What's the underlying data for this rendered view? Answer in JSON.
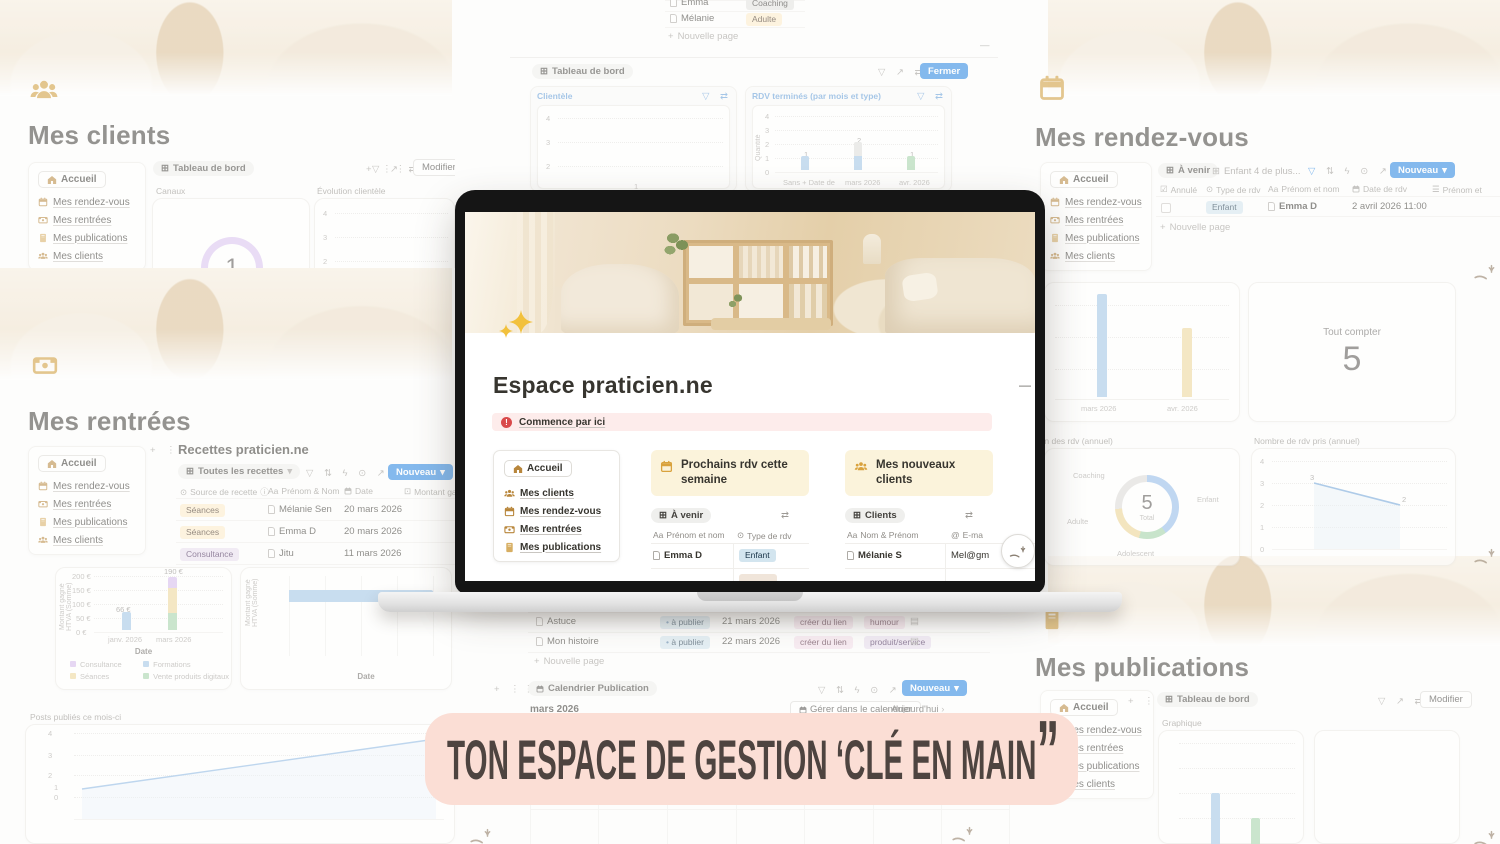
{
  "banner": {
    "text": "TON ESPACE DE GESTION ‘CLÉ EN MAIN",
    "end_quote": "”",
    "bg": "#fbded5",
    "text_color": "#4e4440"
  },
  "common": {
    "accueil": "Accueil",
    "nav_rdv": "Mes rendez-vous",
    "nav_rentrees": "Mes rentrées",
    "nav_publications": "Mes publications",
    "nav_clients": "Mes clients",
    "new_button": "Nouveau",
    "new_page": "Nouvelle page",
    "modify": "Modifier",
    "dashboard": "Tableau de bord"
  },
  "clients": {
    "heading": "Mes clients"
  },
  "rdv": {
    "heading": "Mes rendez-vous",
    "tab_avenir": "À venir",
    "tab_enfant": "Enfant",
    "tab_more": "4 de plus...",
    "col_annule": "Annulé",
    "col_type": "Type de rdv",
    "col_prenom": "Prénom et nom",
    "col_date": "Date de rdv",
    "col_prenom2": "Prénom et",
    "row": {
      "type": "Enfant",
      "name": "Emma D",
      "date": "2 avril 2026 11:00"
    }
  },
  "rentrees": {
    "heading": "Mes rentrées",
    "db_title": "Recettes praticien.ne",
    "tab_toutes": "Toutes les recettes",
    "col_source": "Source de recette",
    "col_nom": "Prénom & Nom",
    "col_date": "Date",
    "col_montant": "Montant gag",
    "rows": [
      {
        "source": "Séances",
        "name": "Mélanie Sen",
        "date": "20 mars 2026"
      },
      {
        "source": "Séances",
        "name": "Emma D",
        "date": "20 mars 2026"
      },
      {
        "source": "Consultance",
        "name": "Jitu",
        "date": "11 mars 2026"
      }
    ]
  },
  "publications": {
    "heading": "Mes publications"
  },
  "top_center": {
    "rows": [
      {
        "name": "Emma",
        "tag": "Coaching"
      },
      {
        "name": "Mélanie",
        "tag": "Adulte"
      }
    ],
    "fermer": "Fermer"
  },
  "bottom_center": {
    "rows": [
      {
        "name": "Astuce",
        "status": "à publier",
        "date": "21 mars 2026",
        "tag1": "créer du lien",
        "tag2": "humour"
      },
      {
        "name": "Mon histoire",
        "status": "à publier",
        "date": "22 mars 2026",
        "tag1": "créer du lien",
        "tag2": "produit/service"
      }
    ],
    "calendar_tab": "Calendrier Publication",
    "month": "mars 2026",
    "manage": "Gérer dans le calendrier",
    "today": "Aujourd'hui",
    "weekdays": [
      "lun.",
      "mar.",
      "mer.",
      "jeu.",
      "ven.",
      "sam.",
      "dim."
    ],
    "days": [
      "2",
      "3",
      "4",
      "5",
      "6",
      "7",
      "8"
    ]
  },
  "laptop": {
    "title": "Espace praticien.ne",
    "callout": "Commence par ici",
    "nav": [
      "Mes clients",
      "Mes rendez-vous",
      "Mes rentrées",
      "Mes publications"
    ],
    "accueil": "Accueil",
    "card_rdv_title": "Prochains rdv cette semaine",
    "card_clients_title": "Mes nouveaux clients",
    "tab_avenir": "À venir",
    "tab_clients": "Clients",
    "col_prenom": "Prénom et nom",
    "col_type": "Type de rdv",
    "col_nom": "Nom & Prénom",
    "col_email": "E-ma",
    "row1_name": "Emma D",
    "row1_tag": "Enfant",
    "row2_name": "Mélanie S",
    "row2_email": "Mel@gm"
  },
  "chart_data": [
    {
      "name": "canaux",
      "type": "donut",
      "title": "Canaux",
      "center": "1",
      "segments": [
        {
          "label": "",
          "frac": 1,
          "color": "#d9c2f0"
        }
      ]
    },
    {
      "name": "evolution-clientele",
      "type": "line",
      "title": "Évolution clientèle",
      "yticks": [
        "4",
        "3",
        "2"
      ]
    },
    {
      "name": "clientele",
      "type": "bar",
      "title": "Clientèle",
      "yticks": [
        "4",
        "3",
        "2"
      ],
      "partial_label": "1"
    },
    {
      "name": "rdv-termines",
      "type": "bar",
      "title": "RDV terminés (par mois et type)",
      "ylabel": "Quantité",
      "yticks": [
        "4",
        "3",
        "2",
        "1",
        "0"
      ],
      "ymax": 4,
      "categories": [
        "Sans + Date de",
        "mars 2026",
        "avr. 2026"
      ],
      "totals": [
        "1",
        "2",
        "1"
      ],
      "series": [
        {
          "name": "blue",
          "color": "#9dc3e6",
          "values": [
            1,
            1,
            0
          ]
        },
        {
          "name": "gray",
          "color": "#dedddb",
          "values": [
            0,
            1,
            0
          ]
        },
        {
          "name": "green",
          "color": "#a2d3a8",
          "values": [
            0,
            0,
            1
          ]
        }
      ]
    },
    {
      "name": "rdv-par-mois",
      "type": "bar",
      "categories": [
        "mars 2026",
        "avr. 2026"
      ],
      "values": [
        3,
        2
      ],
      "labels": [
        "3",
        "2"
      ],
      "colors": [
        "#9dc3e6",
        "#eed698"
      ],
      "ymax": 4
    },
    {
      "name": "tout-compter",
      "type": "number",
      "title": "Tout compter",
      "value": "5"
    },
    {
      "name": "repartition-rdv",
      "type": "donut",
      "title": "Répartition des rdv (annuel)",
      "center": "5",
      "center_sub": "Total",
      "segments": [
        {
          "label": "Enfant",
          "frac": 0.4,
          "color": "#8fb9e9"
        },
        {
          "label": "Adolescent",
          "frac": 0.14,
          "color": "#9ed0a4"
        },
        {
          "label": "Adulte",
          "frac": 0.2,
          "color": "#ecd28e"
        },
        {
          "label": "Coaching",
          "frac": 0.26,
          "color": "#dcdad7"
        }
      ]
    },
    {
      "name": "nb-rdv-pris",
      "type": "line",
      "title": "Nombre de rdv pris (annuel)",
      "yticks": [
        "4",
        "3",
        "2",
        "1",
        "0"
      ],
      "ymax": 4,
      "points": [
        {
          "label": "3",
          "value": 3
        },
        {
          "label": "2",
          "value": 2
        }
      ]
    },
    {
      "name": "montant-gagne",
      "type": "stacked-bar",
      "ylabel": "Montant gagné HTVA (Somme)",
      "xlabel": "Date",
      "ymax": 200,
      "yticks": [
        "200 €",
        "150 €",
        "100 €",
        "50 €",
        "0 €"
      ],
      "categories": [
        "janv. 2026",
        "mars 2026"
      ],
      "bar_labels": [
        "66 €",
        "190 €"
      ],
      "series": [
        {
          "name": "Formations",
          "color": "#9dc3e6",
          "values": [
            66,
            0
          ]
        },
        {
          "name": "Vente produits digitaux",
          "color": "#a2d3a8",
          "values": [
            0,
            60
          ]
        },
        {
          "name": "Séances",
          "color": "#eed698",
          "values": [
            0,
            90
          ]
        },
        {
          "name": "Consultance",
          "color": "#d4b9ec",
          "values": [
            0,
            40
          ]
        }
      ],
      "legend": [
        "Consultance",
        "Séances",
        "Formations",
        "Vente produits digitaux"
      ]
    },
    {
      "name": "montant-tva",
      "type": "hbar",
      "ylabel": "Trimestre",
      "xlabel": "Montant TVA (€) (Somme)",
      "xmax": 60,
      "categories": [
        "2026 T1"
      ],
      "values": [
        53.81
      ],
      "value_labels": [
        "53,81"
      ],
      "xticks": [
        "0,00",
        "15,00",
        "30,00",
        "45,00",
        "60,00"
      ]
    },
    {
      "name": "toutes-recettes",
      "type": "area-line",
      "title": "Toutes les recettes",
      "ylabel": "Montant gagné HTVA (Somme)",
      "xlabel": "Date",
      "yticks": [
        "200 €",
        "150 €",
        "100 €",
        "66 €",
        "50 €",
        "0 €"
      ],
      "x": [
        "janv. 2026",
        "mars 2026"
      ],
      "values": [
        66,
        190
      ],
      "end_label": "190 €"
    },
    {
      "name": "posts-publies",
      "type": "bar",
      "title": "Posts publiés ce mois-ci",
      "yticks": [
        "4",
        "3",
        "2",
        "1",
        "0"
      ],
      "ymax": 4,
      "values": [
        2,
        1
      ],
      "labels": [
        "2",
        "1"
      ],
      "colors": [
        "#9dc3e6",
        "#a2d3a8"
      ]
    },
    {
      "name": "graphique",
      "type": "donut",
      "title": "Graphique",
      "center": "3",
      "segments": [
        {
          "label": "humour",
          "frac": 0.375,
          "color": "#edbcbc"
        },
        {
          "label": "organisation",
          "frac": 0.25,
          "color": "#e3c99a"
        },
        {
          "label": "produit/service",
          "frac": 0.375,
          "color": "#8fb9e9"
        }
      ]
    }
  ],
  "colors": {
    "accent_blue": "#2383e2",
    "tag_blue": "#d3e5ef",
    "tag_yellow": "#fdecc8",
    "tag_purple": "#e8deee",
    "tag_pink": "#f5dfeb",
    "tag_gray": "#e3e2e0",
    "banner_bg": "#fbded5",
    "banner_text": "#4e4440",
    "gold_icon": "#d7ae62"
  }
}
